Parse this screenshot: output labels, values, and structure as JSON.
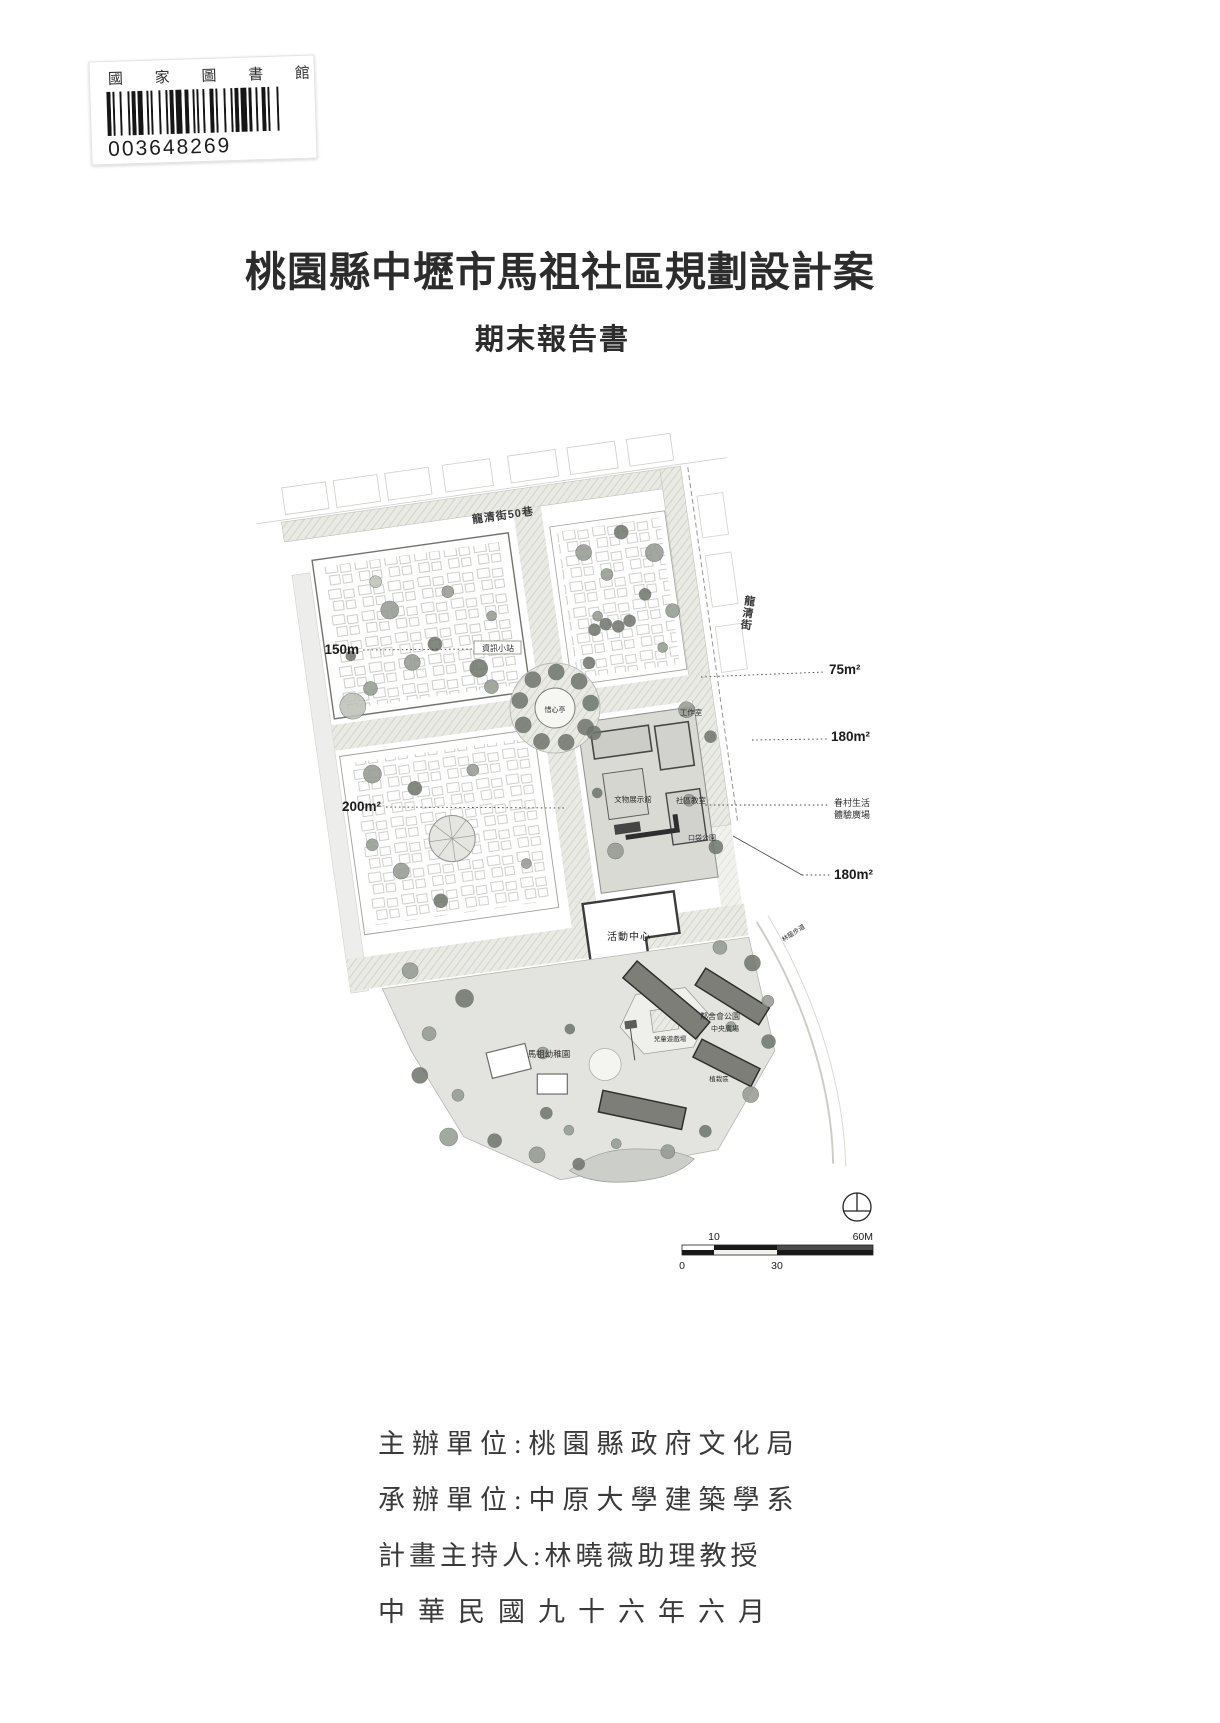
{
  "library_sticker": {
    "institution": "國 家 圖 書 館",
    "barcode_number": "003648269"
  },
  "title": {
    "main": "桃園縣中壢市馬祖社區規劃設計案",
    "subtitle": "期末報告書"
  },
  "site_plan": {
    "roads": {
      "top_street": "龍清街50巷",
      "right_street": "龍清街"
    },
    "dimensions": {
      "d150": "150m",
      "d200": "200m²",
      "d75": "75m²",
      "d180a": "180m²",
      "d180b": "180m²"
    },
    "callout": {
      "line1": "眷村生活",
      "line2": "體驗廣場"
    },
    "labels": {
      "info_station": "資訊小站",
      "pavilion": "惜心亭",
      "workshop": "工作室",
      "exhibit_hall": "文物展示館",
      "community_classroom": "社區教室",
      "pocket_park": "口袋公園",
      "activity_center": "活動中心",
      "neighborhood_park": "鄰舍會公園",
      "central_plaza": "中央廣場",
      "children_playground": "兒童遊戲場",
      "kindergarten": "馬祖幼稚園",
      "green_walk": "林蔭步道",
      "planting_area": "植栽區"
    },
    "scale_bar": {
      "top_left": "10",
      "top_right": "60M",
      "bottom_left": "0",
      "bottom_mid": "30"
    }
  },
  "credits": {
    "organizer": "主辦單位:桃園縣政府文化局",
    "executor": "承辦單位:中原大學建築學系",
    "director": "計畫主持人:林曉薇助理教授",
    "date": "中華民國九十六年六月"
  }
}
